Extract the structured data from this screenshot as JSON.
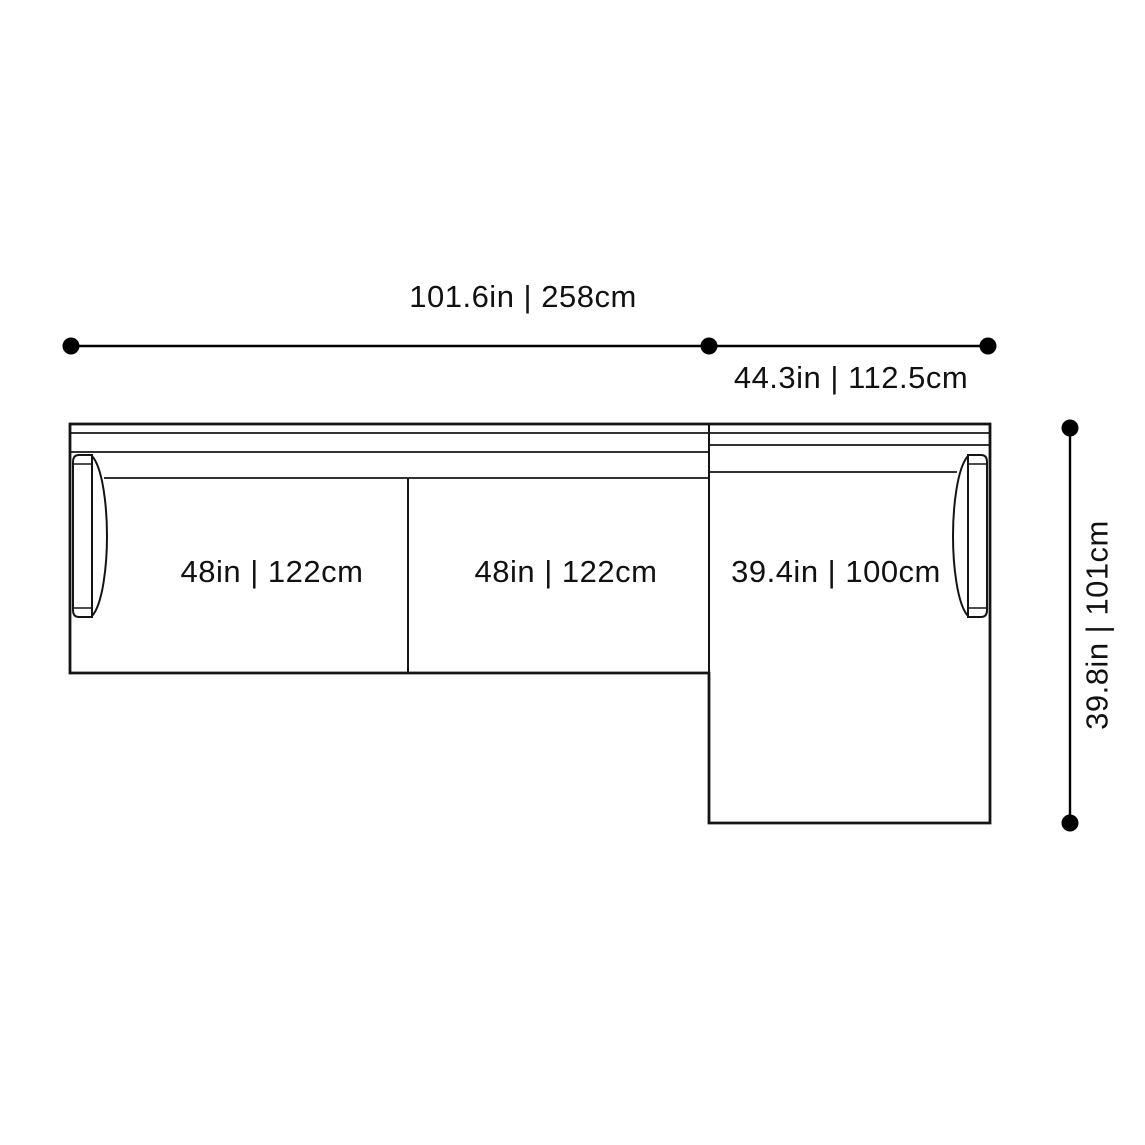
{
  "page": {
    "background_color": "#ffffff"
  },
  "diagram": {
    "type": "sectional-sofa-top-view-dimension-drawing",
    "line_color": "#141414",
    "dimension_color": "#000000",
    "text_color": "#111111",
    "labels": {
      "total_width": "101.6in | 258cm",
      "chaise_section_width": "44.3in | 112.5cm",
      "seat_1_width": "48in | 122cm",
      "seat_2_width": "48in | 122cm",
      "chaise_inner_width": "39.4in | 100cm",
      "chaise_depth": "39.8in | 101cm"
    }
  }
}
